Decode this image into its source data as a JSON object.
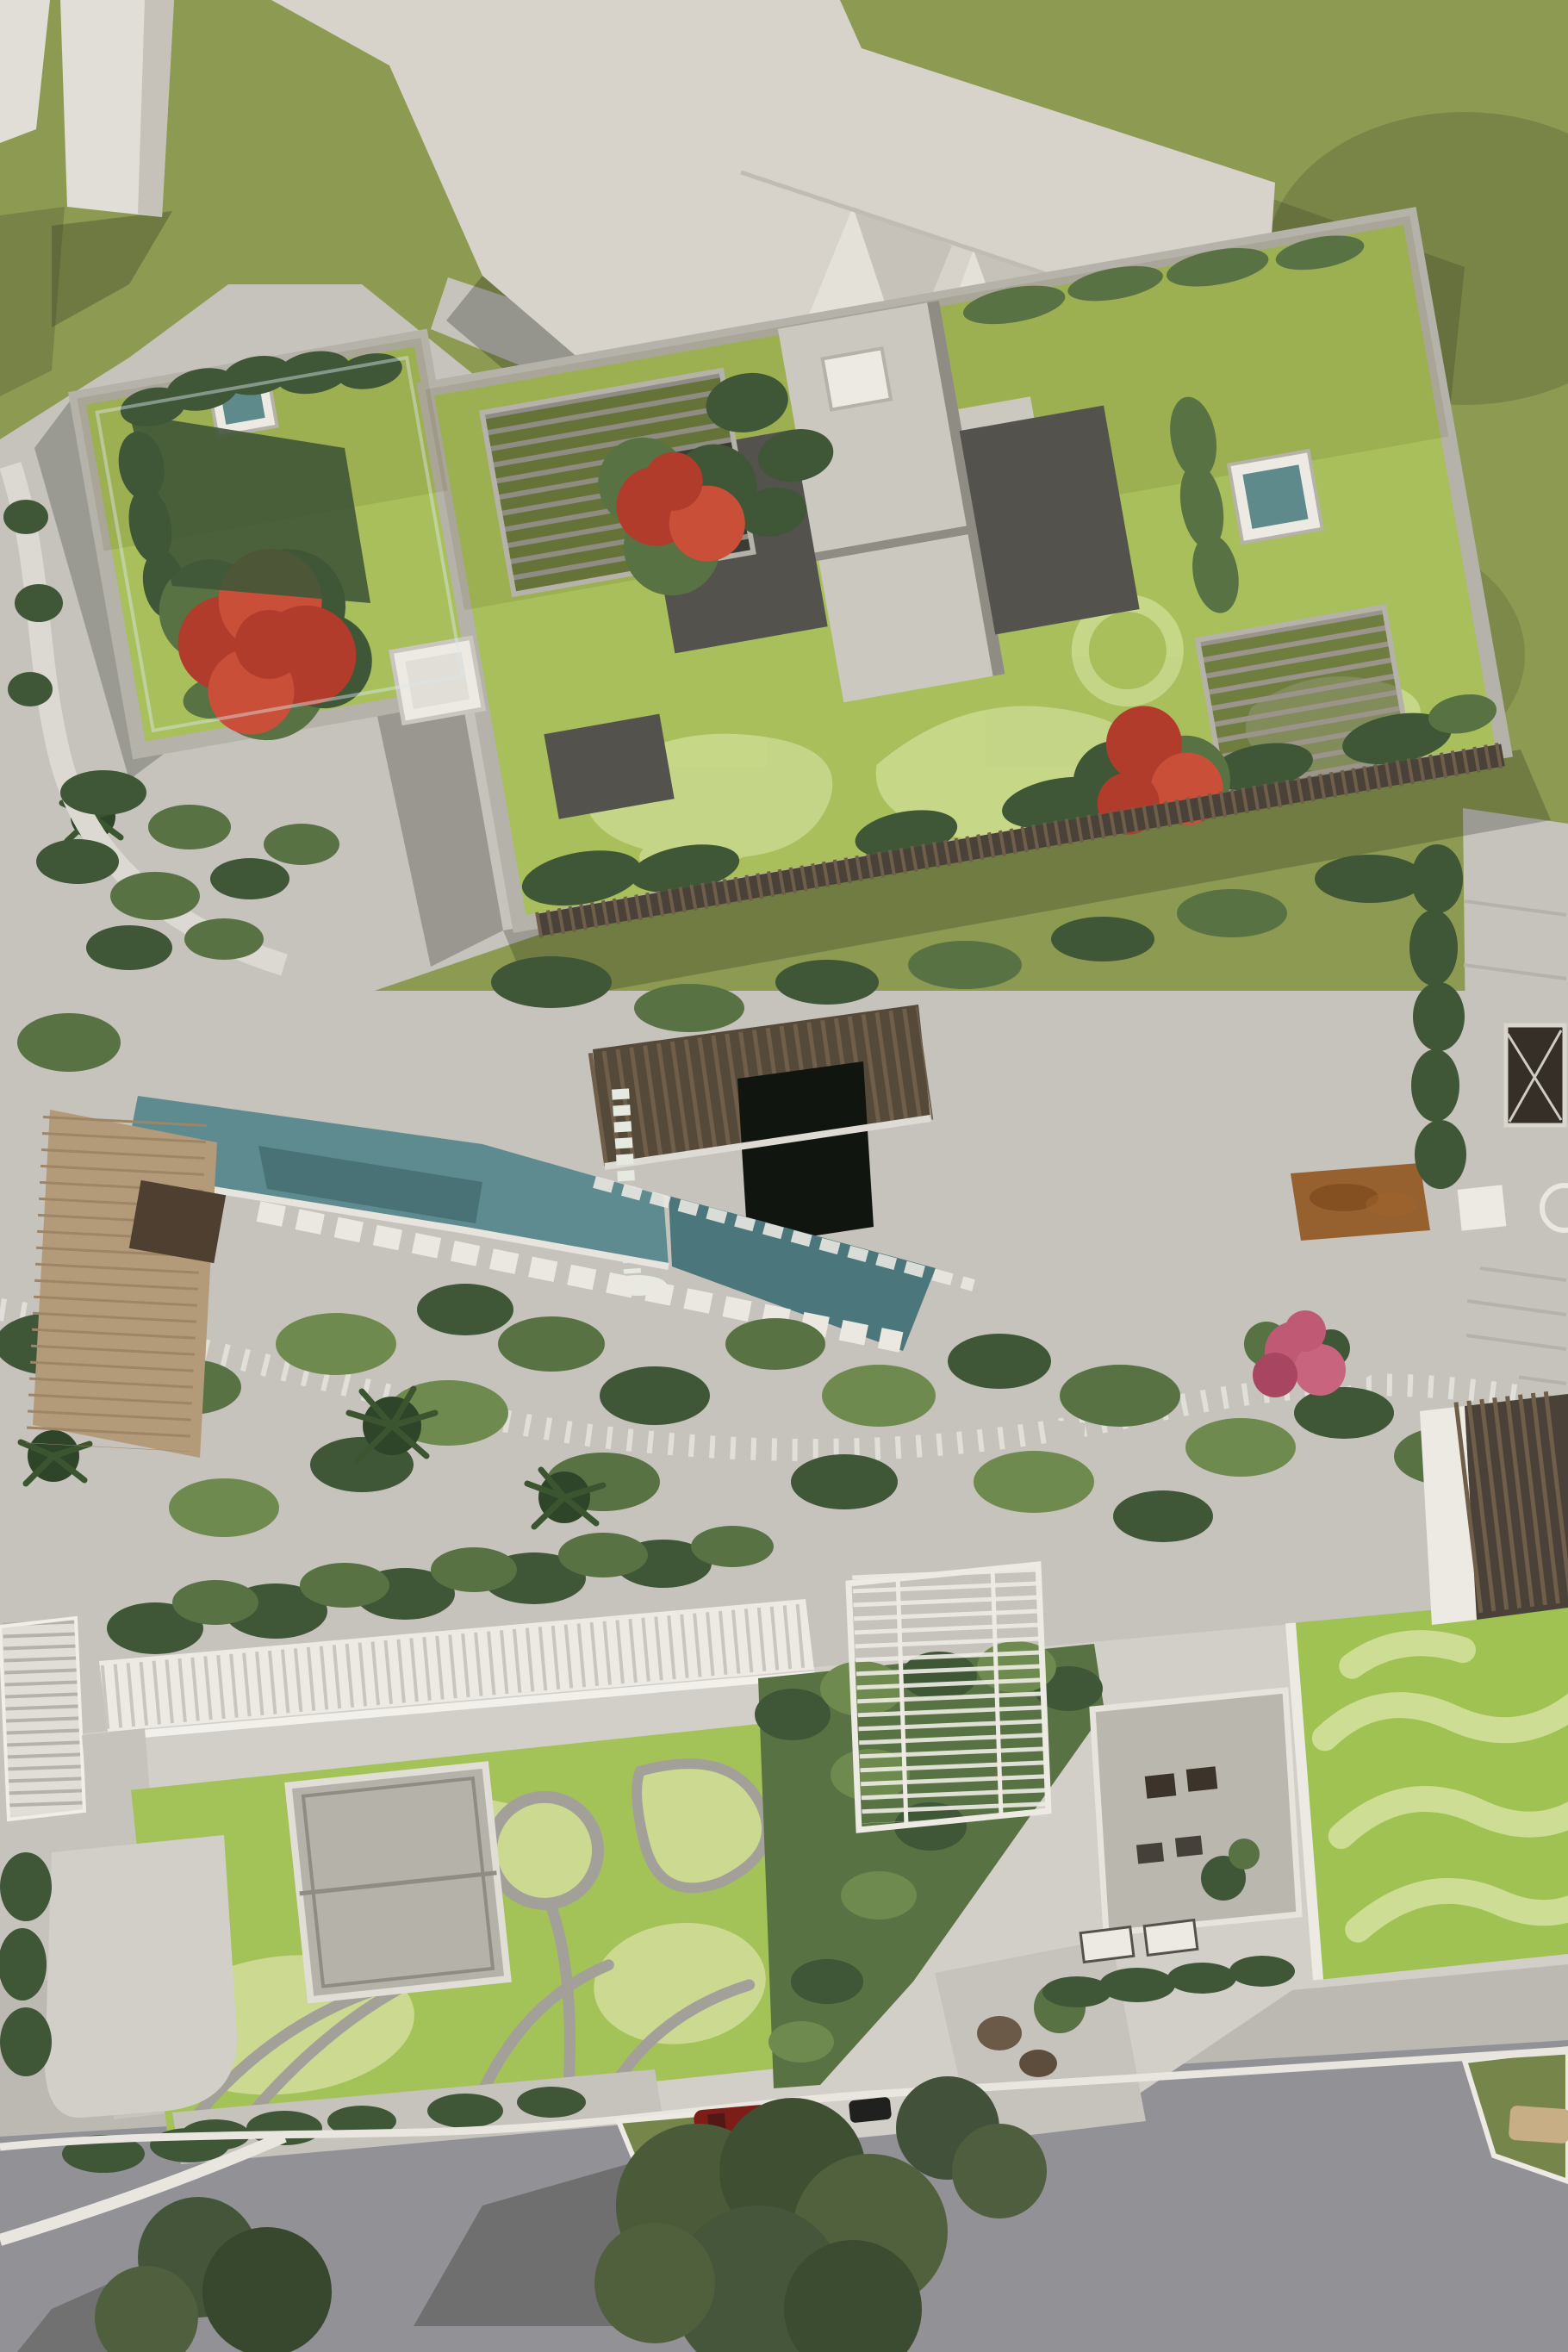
{
  "scene": {
    "type": "aerial-architectural-render",
    "view": "top-down drone view, daytime, sun from upper right",
    "description": "Top-down aerial 3D rendering of a residential development: an upper apartment block with landscaped green roof, concrete cross-shaped core, dark service roofs, timber pergolas, spa and skylight boxes and red flowering flame trees; a ground-level garden belt with a teal pond, white stepping stones, palms and winding paths; a lower building with a swirl-patterned green roof, grey roof boxes, a white louvre skylight band, a white trellis pergola over a shrub wedge, a sunken furnished patio and a wave-striped green roof; a grey street at the bottom with shade trees, a grass traffic island, a red car, a beige car and a scooter; white context massing buildings and olive lawns at the top.",
    "feature_counts": {
      "red_flowering_trees": 3,
      "pergolas": 4,
      "spa_boxes": 2,
      "skylight_boxes": 4,
      "palm_trees": 4,
      "cars": 2,
      "scooters": 1
    }
  },
  "palette": {
    "plaza": "#c6c3bc",
    "plaza_light": "#d2cfc8",
    "sidewalk": "#bcb9b3",
    "lawn": "#8d9a52",
    "lawn_dark": "#76854a",
    "roof_grass": "#a8bf5b",
    "mow_light": "#cbda90",
    "swirl_grass": "#a3c258",
    "wavy_grass": "#9fc252",
    "stripe_light": "#d3e29c",
    "swirl_path": "#a3a09a",
    "shrub_dark": "#3f5637",
    "shrub_mid": "#587244",
    "shrub_light": "#6f8a4e",
    "shrub_pale": "#8ba557",
    "concrete": "#cbc8c0",
    "concrete_shade": "#8f8c84",
    "parapet": "#b5b2aa",
    "white": "#eceae3",
    "off_white": "#e0ded6",
    "cream": "#d7d3ca",
    "cream_light": "#e4e1d9",
    "cream_shade": "#c6c2b9",
    "dark_roof": "#53524d",
    "wood_dark": "#4a4138",
    "wood_mid": "#6e5e4a",
    "louver_brown": "#554939",
    "band_slat": "#c9c6bf",
    "water": "#5d8b90",
    "water_dark": "#4a767c",
    "spa_water": "#5f8a8c",
    "flame_red": "#b23c2c",
    "flame_red_light": "#c94f38",
    "pink_flower": "#c05a74",
    "rust_bed": "#96602f",
    "road": "#929195",
    "deck_wood": "#b39a79",
    "deck_line": "#9e8565",
    "car_red": "#7d1d17",
    "car_beige": "#c7ae85",
    "scooter_black": "#20201e",
    "void_black": "#11150f"
  }
}
